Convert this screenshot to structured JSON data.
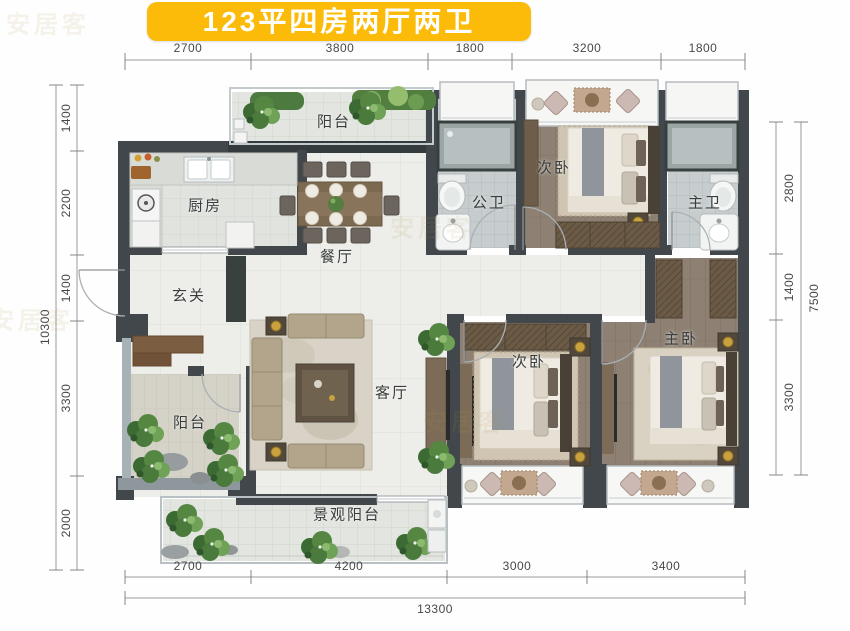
{
  "title": "123平四房两厅两卫",
  "colors": {
    "title_bg": "#FBBB08",
    "wall": "#42474c",
    "wall_marble": "#343b3c",
    "wood_floor": "#8e8173",
    "accent_gold": "#c9a23f"
  },
  "rooms": [
    {
      "id": "balcony-top",
      "label": "阳台",
      "x": 334,
      "y": 121
    },
    {
      "id": "kitchen",
      "label": "厨房",
      "x": 205,
      "y": 205
    },
    {
      "id": "dining",
      "label": "餐厅",
      "x": 337,
      "y": 256
    },
    {
      "id": "bath-public",
      "label": "公卫",
      "x": 489,
      "y": 202
    },
    {
      "id": "bedroom-top",
      "label": "次卧",
      "x": 554,
      "y": 167
    },
    {
      "id": "bath-master",
      "label": "主卫",
      "x": 705,
      "y": 202
    },
    {
      "id": "entry",
      "label": "玄关",
      "x": 189,
      "y": 295
    },
    {
      "id": "balcony-left",
      "label": "阳台",
      "x": 190,
      "y": 422
    },
    {
      "id": "living",
      "label": "客厅",
      "x": 392,
      "y": 392
    },
    {
      "id": "bedroom-bottom",
      "label": "次卧",
      "x": 529,
      "y": 361
    },
    {
      "id": "bedroom-master",
      "label": "主卧",
      "x": 681,
      "y": 338
    },
    {
      "id": "balcony-view",
      "label": "景观阳台",
      "x": 347,
      "y": 514
    }
  ],
  "dimensions": {
    "top": [
      {
        "value": "2700",
        "x": 188,
        "y": 48
      },
      {
        "value": "3800",
        "x": 340,
        "y": 48
      },
      {
        "value": "1800",
        "x": 470,
        "y": 48
      },
      {
        "value": "3200",
        "x": 587,
        "y": 48
      },
      {
        "value": "1800",
        "x": 703,
        "y": 48
      }
    ],
    "bottom": [
      {
        "value": "2700",
        "x": 188,
        "y": 566
      },
      {
        "value": "4200",
        "x": 349,
        "y": 566
      },
      {
        "value": "3000",
        "x": 517,
        "y": 566
      },
      {
        "value": "3400",
        "x": 666,
        "y": 566
      }
    ],
    "bottom_total": {
      "value": "13300",
      "x": 435,
      "y": 609
    },
    "left": [
      {
        "value": "1400",
        "x": 66,
        "y": 118
      },
      {
        "value": "2200",
        "x": 66,
        "y": 203
      },
      {
        "value": "1400",
        "x": 66,
        "y": 288
      },
      {
        "value": "3300",
        "x": 66,
        "y": 398
      },
      {
        "value": "2000",
        "x": 66,
        "y": 523
      }
    ],
    "left_total": {
      "value": "10300",
      "x": 45,
      "y": 327
    },
    "right": [
      {
        "value": "2800",
        "x": 789,
        "y": 188
      },
      {
        "value": "1400",
        "x": 789,
        "y": 287
      },
      {
        "value": "3300",
        "x": 789,
        "y": 397
      }
    ],
    "right_total": {
      "value": "7500",
      "x": 814,
      "y": 298
    }
  },
  "watermark": {
    "text": "安居客",
    "positions": [
      {
        "x": 48,
        "y": 22
      },
      {
        "x": 432,
        "y": 226
      },
      {
        "x": 465,
        "y": 420
      },
      {
        "x": 32,
        "y": 318
      }
    ]
  }
}
